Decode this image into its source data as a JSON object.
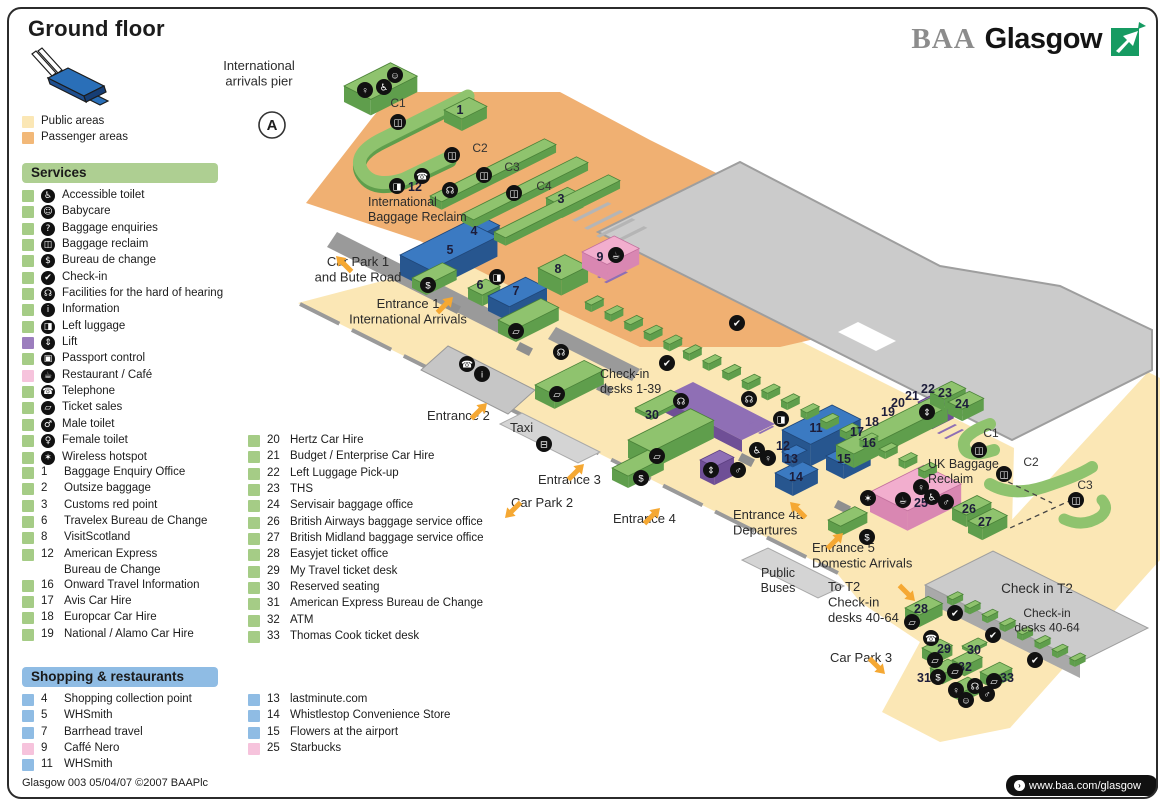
{
  "title": "Ground floor",
  "brand": {
    "baa": "BAA",
    "glasgow": "Glasgow"
  },
  "area_legend": [
    {
      "label": "Public areas",
      "color": "#FBE7B5"
    },
    {
      "label": "Passenger areas",
      "color": "#F2B878"
    }
  ],
  "services": {
    "header": "Services",
    "icon_items": [
      {
        "icon": "accessible-toilet",
        "glyph": "♿",
        "label": "Accessible toilet",
        "chip": "#A5CC86"
      },
      {
        "icon": "babycare",
        "glyph": "☺",
        "label": "Babycare",
        "chip": "#A5CC86"
      },
      {
        "icon": "baggage-enquiries",
        "glyph": "?",
        "label": "Baggage enquiries",
        "chip": "#A5CC86"
      },
      {
        "icon": "baggage-reclaim",
        "glyph": "◫",
        "label": "Baggage reclaim",
        "chip": "#A5CC86"
      },
      {
        "icon": "bureau-de-change",
        "glyph": "$",
        "label": "Bureau de change",
        "chip": "#A5CC86"
      },
      {
        "icon": "check-in",
        "glyph": "✔",
        "label": "Check-in",
        "chip": "#A5CC86"
      },
      {
        "icon": "hard-of-hearing",
        "glyph": "☊",
        "label": "Facilities for the hard of hearing",
        "chip": "#A5CC86"
      },
      {
        "icon": "information",
        "glyph": "i",
        "label": "Information",
        "chip": "#A5CC86"
      },
      {
        "icon": "left-luggage",
        "glyph": "◨",
        "label": "Left luggage",
        "chip": "#A5CC86"
      },
      {
        "icon": "lift",
        "glyph": "⇕",
        "label": "Lift",
        "chip": "#9C7EBE"
      },
      {
        "icon": "passport-control",
        "glyph": "▣",
        "label": "Passport control",
        "chip": "#A5CC86"
      },
      {
        "icon": "restaurant-cafe",
        "glyph": "☕",
        "label": "Restaurant / Café",
        "chip": "#F6C3DC"
      },
      {
        "icon": "telephone",
        "glyph": "☎",
        "label": "Telephone",
        "chip": "#A5CC86"
      },
      {
        "icon": "ticket-sales",
        "glyph": "▱",
        "label": "Ticket sales",
        "chip": "#A5CC86"
      },
      {
        "icon": "male-toilet",
        "glyph": "♂",
        "label": "Male toilet",
        "chip": "#A5CC86"
      },
      {
        "icon": "female-toilet",
        "glyph": "♀",
        "label": "Female toilet",
        "chip": "#A5CC86"
      },
      {
        "icon": "wireless-hotspot",
        "glyph": "✶",
        "label": "Wireless hotspot",
        "chip": "#A5CC86"
      }
    ],
    "numbered_items": [
      {
        "num": "1",
        "label": "Baggage Enquiry Office"
      },
      {
        "num": "2",
        "label": "Outsize baggage"
      },
      {
        "num": "3",
        "label": "Customs red point"
      },
      {
        "num": "6",
        "label": "Travelex Bureau de Change"
      },
      {
        "num": "8",
        "label": "VisitScotland"
      },
      {
        "num": "12",
        "label": "American Express",
        "label2": "Bureau de Change"
      },
      {
        "num": "16",
        "label": "Onward Travel Information"
      },
      {
        "num": "17",
        "label": "Avis Car Hire"
      },
      {
        "num": "18",
        "label": "Europcar Car Hire"
      },
      {
        "num": "19",
        "label": "National / Alamo Car Hire"
      }
    ],
    "numbered_items_col2": [
      {
        "num": "20",
        "label": "Hertz Car Hire"
      },
      {
        "num": "21",
        "label": "Budget / Enterprise Car Hire"
      },
      {
        "num": "22",
        "label": "Left Luggage Pick-up"
      },
      {
        "num": "23",
        "label": "THS"
      },
      {
        "num": "24",
        "label": "Servisair baggage office"
      },
      {
        "num": "26",
        "label": "British Airways baggage service office"
      },
      {
        "num": "27",
        "label": "British Midland baggage service office"
      },
      {
        "num": "28",
        "label": "Easyjet ticket office"
      },
      {
        "num": "29",
        "label": "My Travel ticket desk"
      },
      {
        "num": "30",
        "label": "Reserved seating"
      },
      {
        "num": "31",
        "label": "American Express Bureau de Change"
      },
      {
        "num": "32",
        "label": "ATM"
      },
      {
        "num": "33",
        "label": "Thomas Cook ticket desk"
      }
    ]
  },
  "shopping": {
    "header": "Shopping & restaurants",
    "col1": [
      {
        "num": "4",
        "label": "Shopping collection point",
        "chip": "#8FBCE4"
      },
      {
        "num": "5",
        "label": "WHSmith",
        "chip": "#8FBCE4"
      },
      {
        "num": "7",
        "label": "Barrhead travel",
        "chip": "#8FBCE4"
      },
      {
        "num": "9",
        "label": "Caffé Nero",
        "chip": "#F6C3DC"
      },
      {
        "num": "11",
        "label": "WHSmith",
        "chip": "#8FBCE4"
      }
    ],
    "col2": [
      {
        "num": "13",
        "label": "lastminute.com",
        "chip": "#8FBCE4"
      },
      {
        "num": "14",
        "label": "Whistlestop Convenience Store",
        "chip": "#8FBCE4"
      },
      {
        "num": "15",
        "label": "Flowers at the airport",
        "chip": "#8FBCE4"
      },
      {
        "num": "25",
        "label": "Starbucks",
        "chip": "#F6C3DC"
      }
    ]
  },
  "footer": {
    "left": "Glasgow 003 05/04/07 ©2007 BAAPlc",
    "right": "www.baa.com/glasgow"
  },
  "icon_glyphs": {
    "accessible-toilet": "♿",
    "babycare": "☺",
    "baggage-enquiries": "?",
    "baggage-reclaim": "◫",
    "bureau-de-change": "$",
    "check-in": "✔",
    "hard-of-hearing": "☊",
    "information": "i",
    "left-luggage": "◨",
    "lift": "⇕",
    "passport-control": "▣",
    "restaurant-cafe": "☕",
    "telephone": "☎",
    "ticket-sales": "▱",
    "male-toilet": "♂",
    "female-toilet": "♀",
    "wireless-hotspot": "✶",
    "bus": "⊟"
  },
  "colors": {
    "publicArea": "#FBE7B5",
    "passengerArea": "#F0B072",
    "roof": "#CBCBCB",
    "roofEdge": "#9E9E9E",
    "wall": "#9A9A9A",
    "green": {
      "top": "#8FC36E",
      "side": "#5F9E4C",
      "edge": "#4A8238"
    },
    "blue": {
      "top": "#3B7AC2",
      "side": "#27568F",
      "edge": "#1F4678"
    },
    "pink": {
      "top": "#F2AECE",
      "side": "#D987B2",
      "edge": "#C2709D"
    },
    "purple": {
      "top": "#8F6FB5",
      "side": "#6F4F96",
      "edge": "#5C3F80"
    },
    "arrow": "#F5A833",
    "iconBg": "#111111",
    "label": "#2B2B2B",
    "headerGreen": "#AECF92",
    "headerBlue": "#8FBCE4",
    "brandGreen": "#169B62",
    "brandGray": "#8C8C8C"
  },
  "map": {
    "pier_badge": {
      "letter": "A",
      "x": 272,
      "y": 125
    },
    "labels": [
      {
        "name": "international-arrivals-pier",
        "lines": [
          "International",
          "arrivals pier"
        ],
        "x": 259,
        "y": 70,
        "size": 13,
        "anchor": "middle"
      },
      {
        "name": "international-baggage-reclaim",
        "lines": [
          "International",
          "Baggage Reclaim"
        ],
        "x": 368,
        "y": 206,
        "size": 12.5,
        "anchor": "start"
      },
      {
        "name": "car-park-1",
        "lines": [
          "Car Park 1",
          "and Bute Road"
        ],
        "x": 358,
        "y": 266,
        "size": 13,
        "anchor": "middle"
      },
      {
        "name": "entrance-1",
        "lines": [
          "Entrance 1",
          "International Arrivals"
        ],
        "x": 408,
        "y": 308,
        "size": 13,
        "anchor": "middle"
      },
      {
        "name": "entrance-2",
        "lines": [
          "Entrance 2"
        ],
        "x": 427,
        "y": 420,
        "size": 13,
        "anchor": "start"
      },
      {
        "name": "taxi",
        "lines": [
          "Taxi"
        ],
        "x": 510,
        "y": 432,
        "size": 13,
        "anchor": "start"
      },
      {
        "name": "entrance-3",
        "lines": [
          "Entrance 3"
        ],
        "x": 538,
        "y": 484,
        "size": 13,
        "anchor": "start"
      },
      {
        "name": "car-park-2",
        "lines": [
          "Car Park 2"
        ],
        "x": 511,
        "y": 507,
        "size": 13,
        "anchor": "start"
      },
      {
        "name": "entrance-4",
        "lines": [
          "Entrance 4"
        ],
        "x": 613,
        "y": 523,
        "size": 13,
        "anchor": "start"
      },
      {
        "name": "check-in-desks-1-39",
        "lines": [
          "Check-in",
          "desks 1-39"
        ],
        "x": 600,
        "y": 378,
        "size": 12.5,
        "anchor": "start"
      },
      {
        "name": "entrance-4a-departures",
        "lines": [
          "Entrance 4a",
          "Departures"
        ],
        "x": 733,
        "y": 519,
        "size": 13,
        "anchor": "start"
      },
      {
        "name": "entrance-5-domestic-arrivals",
        "lines": [
          "Entrance 5",
          "Domestic Arrivals"
        ],
        "x": 812,
        "y": 552,
        "size": 13,
        "anchor": "start"
      },
      {
        "name": "public-buses",
        "lines": [
          "Public",
          "Buses"
        ],
        "x": 778,
        "y": 577,
        "size": 12.5,
        "anchor": "middle"
      },
      {
        "name": "uk-baggage-reclaim",
        "lines": [
          "UK Baggage",
          "Reclaim"
        ],
        "x": 928,
        "y": 468,
        "size": 12.5,
        "anchor": "start"
      },
      {
        "name": "to-t2-check-in",
        "lines": [
          "To T2",
          "Check-in",
          "desks 40-64"
        ],
        "x": 828,
        "y": 591,
        "size": 13,
        "anchor": "start"
      },
      {
        "name": "car-park-3",
        "lines": [
          "Car Park 3"
        ],
        "x": 830,
        "y": 662,
        "size": 13,
        "anchor": "start"
      },
      {
        "name": "check-in-t2",
        "lines": [
          "Check in T2"
        ],
        "x": 1037,
        "y": 593,
        "size": 13.5,
        "anchor": "middle"
      },
      {
        "name": "t2-check-in-desks",
        "lines": [
          "Check-in",
          "desks 40-64"
        ],
        "x": 1047,
        "y": 617,
        "size": 12,
        "anchor": "middle"
      }
    ],
    "carousels": [
      {
        "label": "C1",
        "x": 398,
        "y": 107
      },
      {
        "label": "C2",
        "x": 480,
        "y": 152
      },
      {
        "label": "C3",
        "x": 512,
        "y": 171
      },
      {
        "label": "C4",
        "x": 544,
        "y": 190
      },
      {
        "label": "C1",
        "x": 991,
        "y": 437
      },
      {
        "label": "C2",
        "x": 1031,
        "y": 466
      },
      {
        "label": "C3",
        "x": 1085,
        "y": 489
      }
    ],
    "markers": [
      {
        "n": "1",
        "x": 460,
        "y": 114
      },
      {
        "n": "3",
        "x": 561,
        "y": 203
      },
      {
        "n": "4",
        "x": 474,
        "y": 235
      },
      {
        "n": "5",
        "x": 450,
        "y": 254
      },
      {
        "n": "6",
        "x": 480,
        "y": 289
      },
      {
        "n": "7",
        "x": 516,
        "y": 295
      },
      {
        "n": "8",
        "x": 558,
        "y": 273
      },
      {
        "n": "9",
        "x": 600,
        "y": 261
      },
      {
        "n": "12",
        "x": 415,
        "y": 191
      },
      {
        "n": "30",
        "x": 652,
        "y": 419
      },
      {
        "n": "11",
        "x": 816,
        "y": 432
      },
      {
        "n": "12",
        "x": 783,
        "y": 450
      },
      {
        "n": "13",
        "x": 791,
        "y": 463
      },
      {
        "n": "14",
        "x": 796,
        "y": 481
      },
      {
        "n": "15",
        "x": 844,
        "y": 463
      },
      {
        "n": "16",
        "x": 869,
        "y": 447
      },
      {
        "n": "17",
        "x": 857,
        "y": 436
      },
      {
        "n": "18",
        "x": 872,
        "y": 426
      },
      {
        "n": "19",
        "x": 888,
        "y": 416
      },
      {
        "n": "20",
        "x": 898,
        "y": 407
      },
      {
        "n": "21",
        "x": 912,
        "y": 400
      },
      {
        "n": "22",
        "x": 928,
        "y": 393
      },
      {
        "n": "23",
        "x": 945,
        "y": 397
      },
      {
        "n": "24",
        "x": 962,
        "y": 408
      },
      {
        "n": "25",
        "x": 921,
        "y": 507
      },
      {
        "n": "26",
        "x": 969,
        "y": 513
      },
      {
        "n": "27",
        "x": 985,
        "y": 526
      },
      {
        "n": "28",
        "x": 921,
        "y": 613
      },
      {
        "n": "29",
        "x": 944,
        "y": 653
      },
      {
        "n": "30",
        "x": 974,
        "y": 654
      },
      {
        "n": "31",
        "x": 924,
        "y": 682
      },
      {
        "n": "32",
        "x": 965,
        "y": 671
      },
      {
        "n": "33",
        "x": 1007,
        "y": 682
      }
    ],
    "icons": [
      {
        "g": "female-toilet",
        "x": 365,
        "y": 90
      },
      {
        "g": "accessible-toilet",
        "x": 384,
        "y": 87
      },
      {
        "g": "babycare",
        "x": 395,
        "y": 75
      },
      {
        "g": "baggage-reclaim",
        "x": 398,
        "y": 122
      },
      {
        "g": "baggage-reclaim",
        "x": 452,
        "y": 155
      },
      {
        "g": "baggage-reclaim",
        "x": 484,
        "y": 175
      },
      {
        "g": "baggage-reclaim",
        "x": 514,
        "y": 193
      },
      {
        "g": "left-luggage",
        "x": 397,
        "y": 186
      },
      {
        "g": "telephone",
        "x": 422,
        "y": 176
      },
      {
        "g": "hard-of-hearing",
        "x": 450,
        "y": 190
      },
      {
        "g": "restaurant-cafe",
        "x": 616,
        "y": 255
      },
      {
        "g": "bureau-de-change",
        "x": 428,
        "y": 285
      },
      {
        "g": "left-luggage",
        "x": 497,
        "y": 277
      },
      {
        "g": "ticket-sales",
        "x": 516,
        "y": 331
      },
      {
        "g": "telephone",
        "x": 467,
        "y": 364
      },
      {
        "g": "information",
        "x": 482,
        "y": 374
      },
      {
        "g": "hard-of-hearing",
        "x": 561,
        "y": 352
      },
      {
        "g": "ticket-sales",
        "x": 557,
        "y": 394
      },
      {
        "g": "bus",
        "x": 544,
        "y": 444
      },
      {
        "g": "check-in",
        "x": 667,
        "y": 363
      },
      {
        "g": "hard-of-hearing",
        "x": 681,
        "y": 401
      },
      {
        "g": "check-in",
        "x": 737,
        "y": 323
      },
      {
        "g": "ticket-sales",
        "x": 657,
        "y": 456
      },
      {
        "g": "bureau-de-change",
        "x": 641,
        "y": 478
      },
      {
        "g": "hard-of-hearing",
        "x": 749,
        "y": 399
      },
      {
        "g": "left-luggage",
        "x": 781,
        "y": 419
      },
      {
        "g": "lift",
        "x": 711,
        "y": 470
      },
      {
        "g": "male-toilet",
        "x": 738,
        "y": 470
      },
      {
        "g": "accessible-toilet",
        "x": 757,
        "y": 450
      },
      {
        "g": "female-toilet",
        "x": 768,
        "y": 458
      },
      {
        "g": "lift",
        "x": 927,
        "y": 412
      },
      {
        "g": "wireless-hotspot",
        "x": 868,
        "y": 498
      },
      {
        "g": "bureau-de-change",
        "x": 867,
        "y": 537
      },
      {
        "g": "restaurant-cafe",
        "x": 903,
        "y": 500
      },
      {
        "g": "female-toilet",
        "x": 921,
        "y": 487
      },
      {
        "g": "accessible-toilet",
        "x": 932,
        "y": 497
      },
      {
        "g": "male-toilet",
        "x": 946,
        "y": 502
      },
      {
        "g": "baggage-reclaim",
        "x": 979,
        "y": 450
      },
      {
        "g": "baggage-reclaim",
        "x": 1004,
        "y": 474
      },
      {
        "g": "baggage-reclaim",
        "x": 1076,
        "y": 500
      },
      {
        "g": "check-in",
        "x": 955,
        "y": 613
      },
      {
        "g": "check-in",
        "x": 993,
        "y": 635
      },
      {
        "g": "check-in",
        "x": 1035,
        "y": 660
      },
      {
        "g": "ticket-sales",
        "x": 912,
        "y": 622
      },
      {
        "g": "telephone",
        "x": 931,
        "y": 638
      },
      {
        "g": "ticket-sales",
        "x": 935,
        "y": 660
      },
      {
        "g": "ticket-sales",
        "x": 955,
        "y": 671
      },
      {
        "g": "bureau-de-change",
        "x": 938,
        "y": 677
      },
      {
        "g": "female-toilet",
        "x": 956,
        "y": 690
      },
      {
        "g": "hard-of-hearing",
        "x": 975,
        "y": 686
      },
      {
        "g": "ticket-sales",
        "x": 994,
        "y": 681
      },
      {
        "g": "male-toilet",
        "x": 987,
        "y": 694
      },
      {
        "g": "babycare",
        "x": 966,
        "y": 700
      }
    ],
    "arrows": [
      {
        "x": 336,
        "y": 256,
        "a": 225
      },
      {
        "x": 453,
        "y": 297,
        "a": 315
      },
      {
        "x": 487,
        "y": 403,
        "a": 315
      },
      {
        "x": 584,
        "y": 464,
        "a": 315
      },
      {
        "x": 505,
        "y": 518,
        "a": 135
      },
      {
        "x": 660,
        "y": 508,
        "a": 315
      },
      {
        "x": 790,
        "y": 502,
        "a": 225
      },
      {
        "x": 843,
        "y": 533,
        "a": 315
      },
      {
        "x": 915,
        "y": 601,
        "a": 45
      },
      {
        "x": 885,
        "y": 674,
        "a": 45
      }
    ]
  }
}
